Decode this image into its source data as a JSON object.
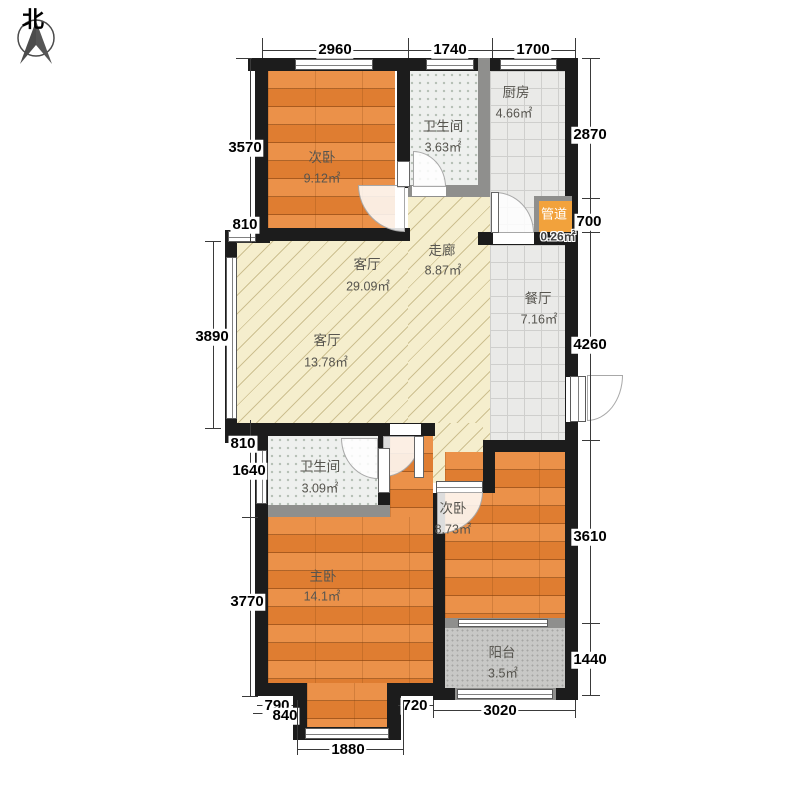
{
  "compass": {
    "label": "北"
  },
  "rooms": [
    {
      "name": "次卧",
      "area": "9.12㎡"
    },
    {
      "name": "卫生间",
      "area": "3.63㎡"
    },
    {
      "name": "厨房",
      "area": "4.66㎡"
    },
    {
      "name": "管道",
      "area": "0.26㎡"
    },
    {
      "name": "走廊",
      "area": "8.87㎡"
    },
    {
      "name": "客厅",
      "area": "29.09㎡"
    },
    {
      "name": "餐厅",
      "area": "7.16㎡"
    },
    {
      "name": "客厅",
      "area": "13.78㎡"
    },
    {
      "name": "卫生间",
      "area": "3.09㎡"
    },
    {
      "name": "主卧",
      "area": "14.1㎡"
    },
    {
      "name": "次卧",
      "area": "8.73㎡"
    },
    {
      "name": "阳台",
      "area": "3.5㎡"
    }
  ],
  "dimensions": {
    "top": [
      "2960",
      "1740",
      "1700"
    ],
    "left": [
      "3570",
      "810",
      "3890",
      "810",
      "1640",
      "3770"
    ],
    "right": [
      "2870",
      "700",
      "4260",
      "3610",
      "1440"
    ],
    "bottom": [
      "790",
      "840",
      "720",
      "1880",
      "3020"
    ]
  },
  "colors": {
    "wall": "#1c1c1c",
    "light_wall": "#8f8f8d",
    "wood_floor": "#e6893f",
    "tile_floor": "#eaeae8",
    "hatch_floor": "#f5eecd",
    "bath_floor": "#eef0ee",
    "duct_fill": "#f2a23c"
  }
}
